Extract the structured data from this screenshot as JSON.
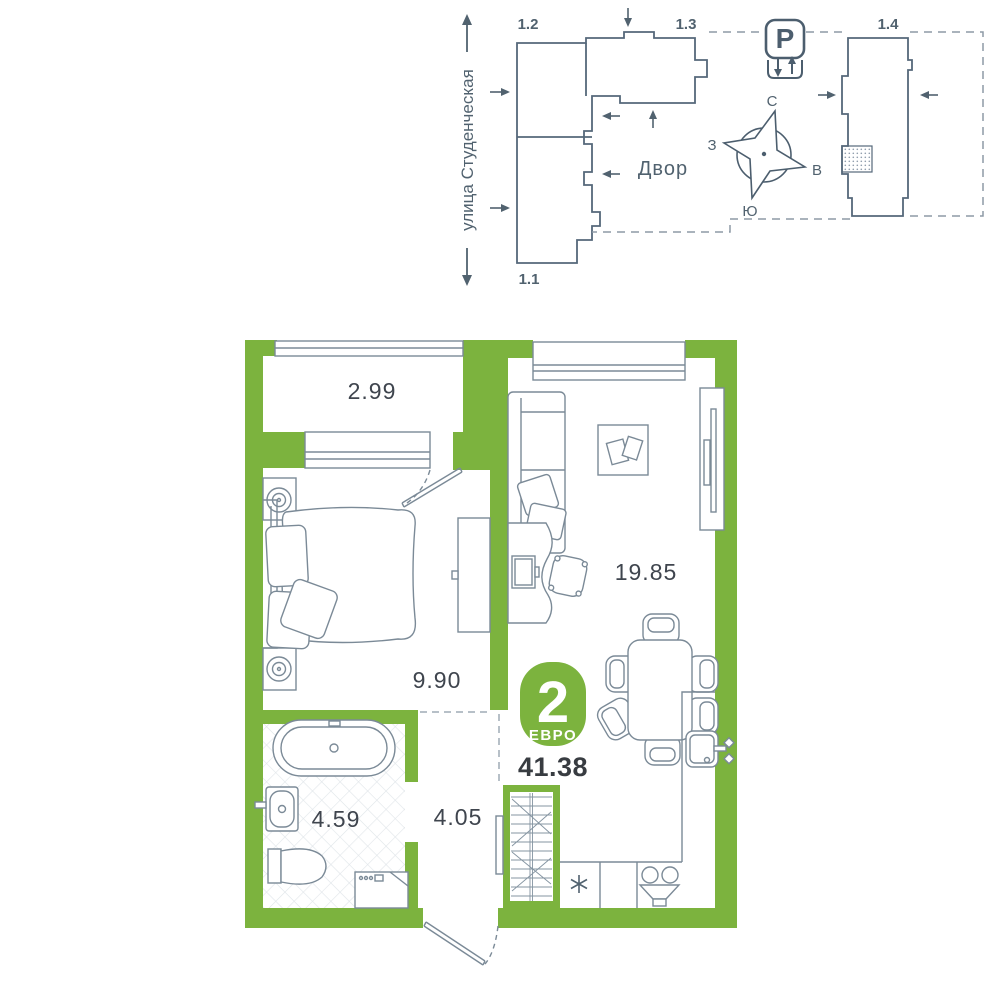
{
  "site_plan": {
    "street_label": "улица Студенческая",
    "courtyard_label": "Двор",
    "parking_label": "P",
    "building_labels": {
      "b1_1": "1.1",
      "b1_2": "1.2",
      "b1_3": "1.3",
      "b1_4": "1.4"
    },
    "compass": {
      "north": "С",
      "south": "Ю",
      "west": "З",
      "east": "В"
    }
  },
  "apartment": {
    "badge": {
      "rooms": "2",
      "type": "ЕВРО"
    },
    "total_area": "41.38",
    "areas": {
      "balcony": "2.99",
      "bedroom": "9.90",
      "living_kitchen": "19.85",
      "bathroom": "4.59",
      "hallway": "4.05"
    }
  },
  "colors": {
    "wall_green": "#7cb33e",
    "plan_slate": "#51626f",
    "furniture_gray": "#7b8a97",
    "label_dark": "#3f454e"
  }
}
